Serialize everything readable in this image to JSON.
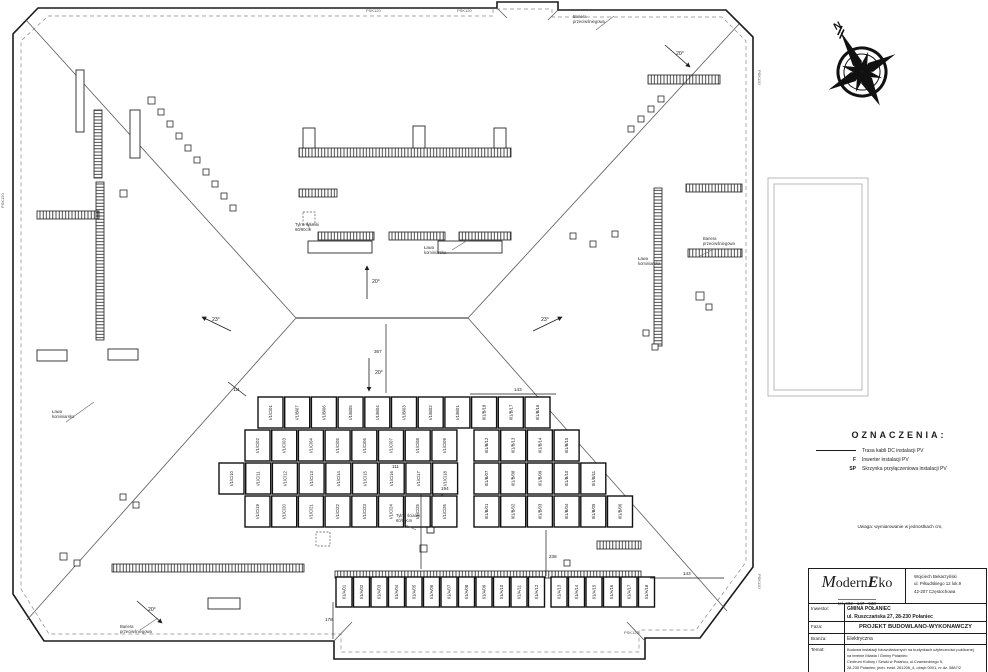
{
  "page": {
    "line_color": "#1c1c1c",
    "faint_color": "#a8a8a8",
    "bg": "#ffffff"
  },
  "compass": {
    "north_label": "N"
  },
  "legend": {
    "title": "OZNACZENIA:",
    "items": [
      {
        "symbol": "line",
        "label": "Trasa kabli DC instalacji PV"
      },
      {
        "symbol": "F",
        "label": "Inwerter instalacji PV"
      },
      {
        "symbol": "SP",
        "label": "Skrzynka przyłączeniowa instalacji PV"
      }
    ]
  },
  "note": "Uwaga: wymiarowanie w jednostkach cm,",
  "titleblock": {
    "logo": {
      "m": "M",
      "odern": "odern",
      "e": "E",
      "ko": "ko",
      "tel": "tel. 602 - 147 - 538"
    },
    "address_lines": [
      "Wojciech Bekarzyński",
      "ul. Piłsudskiego 12 lok.9",
      "42-207 Częstochowa"
    ],
    "inwestor_label": "Inwestor:",
    "inwestor_name": "GMINA POŁANIEC",
    "inwestor_addr": "ul. Ruszczańska 27, 28-230 Połaniec",
    "faza_label": "Faza:",
    "faza": "PROJEKT BUDOWLANO-WYKONAWCZY",
    "branza_label": "Branża:",
    "branza": "Elektryczna",
    "temat_label": "Temat:",
    "temat_lines": [
      "Budowa instalacji fotowoltaicznych na budynkach użyteczności publicznej",
      "na terenie Miasta i Gminy Połaniec:",
      "Centrum Kultury i Sztuki w Połańcu, ul.Czarnieckiego 5,",
      "28-230 Połaniec; jedn. ewid. 261206_4, obręb 0001, nr dz. 5887/2"
    ],
    "proj_label": "Projektował:",
    "proj_name": "mgr inż. Dariusz Pałka",
    "proj_nr": "nr upr. 09090903",
    "proj_date": "data",
    "proj_sig": "podpis"
  },
  "plan": {
    "panel_rows": [
      {
        "x": 258,
        "y": 397,
        "w": 25,
        "h": 31,
        "pitch": 26.7,
        "labels": [
          "I/1/C/01",
          "I/1/B/07",
          "I/1/B/06",
          "I/1/B/05",
          "I/1/B/04",
          "I/1/B/03",
          "I/1/B/02",
          "I/1/B/01",
          "II/1/B/18",
          "II/1/B/17",
          "II/1/B/16"
        ]
      },
      {
        "x": 245,
        "y": 430,
        "w": 25,
        "h": 31,
        "pitch": 26.7,
        "labels": [
          "I/1/C/02",
          "I/1/C/03",
          "I/1/C/04",
          "I/1/C/05",
          "I/1/C/06",
          "I/1/C/07",
          "I/1/C/08",
          "I/1/C/09"
        ]
      },
      {
        "x": 474,
        "y": 430,
        "w": 25,
        "h": 31,
        "pitch": 26.7,
        "labels": [
          "II/1/B/12",
          "II/1/B/13",
          "II/1/B/14",
          "II/1/B/15"
        ]
      },
      {
        "x": 219,
        "y": 463,
        "w": 25,
        "h": 31,
        "pitch": 26.7,
        "labels": [
          "I/1/C/10",
          "I/1/C/11",
          "I/1/C/12",
          "I/1/C/13",
          "I/1/C/14",
          "I/1/C/15",
          "I/1/C/16",
          "I/1/C/17",
          "I/1/C/18"
        ]
      },
      {
        "x": 474,
        "y": 463,
        "w": 25,
        "h": 31,
        "pitch": 26.7,
        "labels": [
          "II/1/B/07",
          "II/1/B/08",
          "II/1/B/09",
          "II/1/B/10",
          "II/1/B/11"
        ]
      },
      {
        "x": 245,
        "y": 496,
        "w": 25,
        "h": 31,
        "pitch": 26.7,
        "labels": [
          "I/1/C/19",
          "I/1/C/20",
          "I/1/C/21",
          "I/1/C/22",
          "I/1/C/23",
          "I/1/C/24",
          "I/1/C/25",
          "I/1/C/26"
        ]
      },
      {
        "x": 474,
        "y": 496,
        "w": 25,
        "h": 31,
        "pitch": 26.7,
        "labels": [
          "II/1/B/01",
          "II/1/B/02",
          "II/1/B/03",
          "II/1/B/04",
          "II/1/B/05",
          "II/1/B/06"
        ]
      },
      {
        "x": 336,
        "y": 577,
        "w": 16,
        "h": 30,
        "pitch": 17.5,
        "labels": [
          "I/1/A/01",
          "I/1/A/02",
          "I/1/A/03",
          "I/1/A/04",
          "I/1/A/05",
          "I/1/A/06",
          "I/1/A/07",
          "I/1/A/08",
          "I/1/A/09",
          "I/1/A/10",
          "I/1/A/11",
          "I/1/A/12"
        ]
      },
      {
        "x": 551,
        "y": 577,
        "w": 16,
        "h": 30,
        "pitch": 17.5,
        "labels": [
          "I/1/A/13",
          "I/1/A/14",
          "I/1/A/15",
          "I/1/A/16",
          "I/1/A/17",
          "I/1/A/18"
        ]
      }
    ],
    "strips": [
      [
        299,
        148,
        212,
        9,
        "h"
      ],
      [
        299,
        189,
        38,
        8,
        "h"
      ],
      [
        318,
        232,
        56,
        8,
        "h"
      ],
      [
        389,
        232,
        56,
        8,
        "h"
      ],
      [
        459,
        232,
        52,
        8,
        "h"
      ],
      [
        94,
        110,
        8,
        68,
        "v"
      ],
      [
        96,
        182,
        8,
        158,
        "v"
      ],
      [
        37,
        211,
        62,
        8,
        "h"
      ],
      [
        654,
        188,
        8,
        158,
        "v"
      ],
      [
        686,
        184,
        56,
        8,
        "h"
      ],
      [
        688,
        249,
        54,
        8,
        "h"
      ],
      [
        112,
        564,
        192,
        8,
        "h"
      ],
      [
        335,
        571,
        306,
        7,
        "h"
      ],
      [
        648,
        75,
        72,
        9,
        "h"
      ],
      [
        597,
        541,
        44,
        8,
        "h"
      ]
    ],
    "squares": [
      [
        148,
        97,
        7
      ],
      [
        158,
        109,
        6
      ],
      [
        167,
        121,
        6
      ],
      [
        176,
        133,
        6
      ],
      [
        185,
        145,
        6
      ],
      [
        194,
        157,
        6
      ],
      [
        203,
        169,
        6
      ],
      [
        212,
        181,
        6
      ],
      [
        221,
        193,
        6
      ],
      [
        230,
        205,
        6
      ],
      [
        120,
        190,
        7
      ],
      [
        658,
        96,
        6
      ],
      [
        648,
        106,
        6
      ],
      [
        638,
        116,
        6
      ],
      [
        628,
        126,
        6
      ],
      [
        570,
        233,
        6
      ],
      [
        590,
        241,
        6
      ],
      [
        612,
        231,
        6
      ],
      [
        696,
        292,
        8
      ],
      [
        706,
        304,
        6
      ],
      [
        643,
        330,
        6
      ],
      [
        652,
        344,
        6
      ],
      [
        60,
        553,
        7
      ],
      [
        74,
        560,
        6
      ],
      [
        120,
        494,
        6
      ],
      [
        133,
        502,
        6
      ],
      [
        420,
        545,
        7
      ],
      [
        564,
        560,
        6
      ]
    ],
    "dashed_squares": [
      [
        303,
        212,
        12
      ],
      [
        316,
        532,
        14
      ]
    ],
    "rects": [
      [
        76,
        70,
        8,
        62
      ],
      [
        130,
        110,
        10,
        48
      ],
      [
        303,
        128,
        12,
        20
      ],
      [
        413,
        126,
        12,
        22
      ],
      [
        494,
        128,
        12,
        20
      ],
      [
        308,
        241,
        64,
        12
      ],
      [
        438,
        241,
        64,
        12
      ],
      [
        37,
        350,
        30,
        11
      ],
      [
        108,
        349,
        30,
        11
      ],
      [
        208,
        598,
        32,
        11
      ],
      [
        413,
        467,
        16,
        27
      ],
      [
        433,
        489,
        9,
        9
      ],
      [
        427,
        526,
        7,
        7
      ]
    ],
    "faint_rects": [
      [
        768,
        178,
        100,
        218
      ],
      [
        774,
        184,
        88,
        206
      ]
    ],
    "labels": [
      {
        "x": 573,
        "y": 18,
        "lines": [
          "Bariera",
          "przeciwśniegowa"
        ]
      },
      {
        "x": 703,
        "y": 240,
        "lines": [
          "Bariera",
          "przeciwśniegowa"
        ]
      },
      {
        "x": 120,
        "y": 628,
        "lines": [
          "Bariera",
          "przeciwśniegowa"
        ]
      },
      {
        "x": 52,
        "y": 413,
        "lines": [
          "Ława",
          "kominiarska"
        ]
      },
      {
        "x": 638,
        "y": 260,
        "lines": [
          "Ława",
          "kominiarska"
        ]
      },
      {
        "x": 424,
        "y": 249,
        "lines": [
          "Ława",
          "kominiarska"
        ]
      },
      {
        "x": 295,
        "y": 226,
        "lines": [
          "Tylne ścianki",
          "60/80cm"
        ]
      },
      {
        "x": 396,
        "y": 517,
        "lines": [
          "Tylne ścianki",
          "60/80cm"
        ]
      }
    ],
    "psk_markers": [
      {
        "t": "PSK120",
        "x": 366,
        "y": 8,
        "r": 0
      },
      {
        "t": "PSK120",
        "x": 457,
        "y": 8,
        "r": 0
      },
      {
        "t": "PSK120",
        "x": 758,
        "y": 66,
        "r": 90
      },
      {
        "t": "PSK120",
        "x": 758,
        "y": 570,
        "r": 90
      },
      {
        "t": "PSK120",
        "x": 4,
        "y": 204,
        "r": -90
      },
      {
        "t": "PSK120",
        "x": 624,
        "y": 630,
        "r": 0
      }
    ],
    "slope_arrows": [
      {
        "t": "20°",
        "x": 372,
        "y": 283,
        "a": [
          367,
          299,
          367,
          266
        ]
      },
      {
        "t": "20°",
        "x": 375,
        "y": 374,
        "a": [
          369,
          358,
          369,
          391
        ]
      },
      {
        "t": "23°",
        "x": 212,
        "y": 321,
        "a": [
          231,
          331,
          202,
          317
        ]
      },
      {
        "t": "23°",
        "x": 541,
        "y": 321,
        "a": [
          533,
          331,
          562,
          317
        ]
      },
      {
        "t": "20°",
        "x": 676,
        "y": 55,
        "a": [
          665,
          45,
          690,
          67
        ]
      },
      {
        "t": "20°",
        "x": 148,
        "y": 611,
        "a": [
          137,
          601,
          162,
          623
        ]
      }
    ],
    "dims": [
      {
        "t": "111",
        "x": 233,
        "y": 391
      },
      {
        "t": "143",
        "x": 514,
        "y": 391
      },
      {
        "t": "367",
        "x": 374,
        "y": 353
      },
      {
        "t": "111",
        "x": 392,
        "y": 468
      },
      {
        "t": "194",
        "x": 441,
        "y": 490
      },
      {
        "t": "238",
        "x": 549,
        "y": 558
      },
      {
        "t": "143",
        "x": 683,
        "y": 575
      },
      {
        "t": "178",
        "x": 325,
        "y": 621
      }
    ],
    "dim_lines": [
      [
        386,
        324,
        386,
        393
      ],
      [
        470,
        394,
        556,
        394
      ],
      [
        546,
        530,
        546,
        576
      ],
      [
        333,
        602,
        333,
        639
      ],
      [
        650,
        578,
        724,
        578
      ],
      [
        421,
        494,
        421,
        569
      ],
      [
        246,
        396,
        228,
        382
      ]
    ],
    "leaders": [
      [
        596,
        30,
        614,
        16
      ],
      [
        712,
        250,
        700,
        256
      ],
      [
        140,
        630,
        158,
        618
      ],
      [
        66,
        422,
        94,
        402
      ],
      [
        452,
        250,
        468,
        240
      ],
      [
        310,
        230,
        307,
        222
      ],
      [
        404,
        524,
        416,
        530
      ]
    ]
  }
}
